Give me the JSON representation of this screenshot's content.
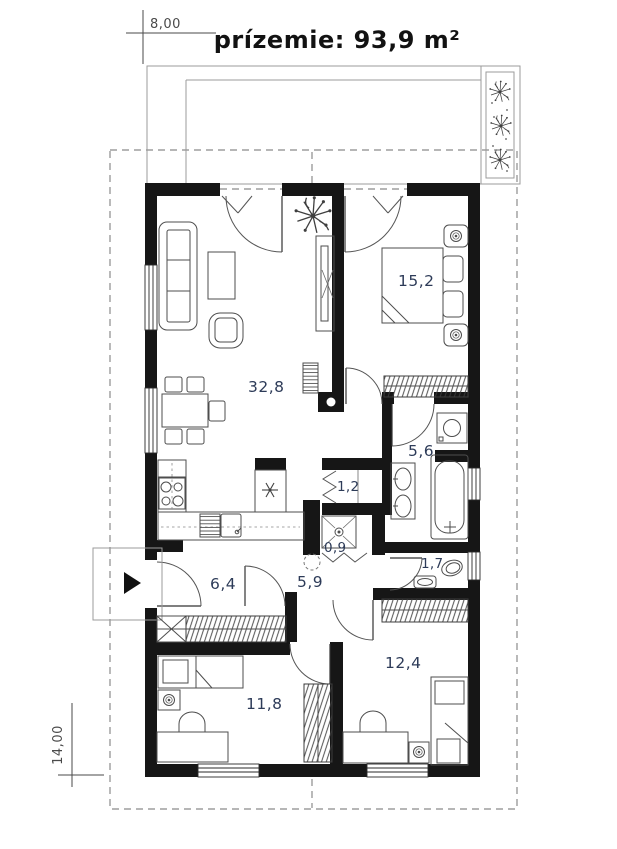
{
  "title": "prízemie: 93,9 m²",
  "dimensions": {
    "width_label": "8,00",
    "height_label": "14,00"
  },
  "rooms": [
    {
      "id": "living-kitchen",
      "area": "32,8"
    },
    {
      "id": "bedroom-main",
      "area": "15,2"
    },
    {
      "id": "bathroom",
      "area": "5,6"
    },
    {
      "id": "closet",
      "area": "1,2"
    },
    {
      "id": "shower",
      "area": "0,9"
    },
    {
      "id": "wc",
      "area": "1,7"
    },
    {
      "id": "entry-hall",
      "area": "6,4"
    },
    {
      "id": "corridor",
      "area": "5,9"
    },
    {
      "id": "bedroom-left",
      "area": "11,8"
    },
    {
      "id": "bedroom-right",
      "area": "12,4"
    }
  ],
  "colors": {
    "wall": "#161616",
    "room_label": "#2d3b58",
    "furniture_line": "#4d4d4d",
    "boundary_dash": "#8b8b8b",
    "title": "#121212"
  }
}
